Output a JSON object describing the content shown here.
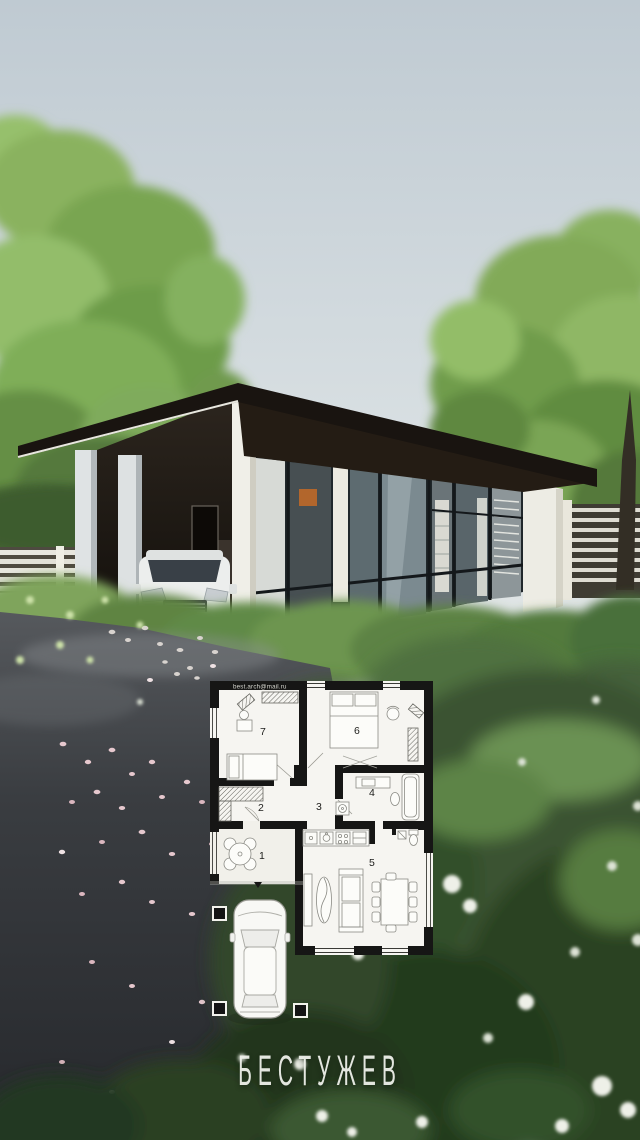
{
  "frame": {
    "title": "БЕСТУЖЕВ",
    "watermark": "best.arch@mail.ru"
  },
  "plan": {
    "rooms": [
      {
        "label": "1"
      },
      {
        "label": "2"
      },
      {
        "label": "3"
      },
      {
        "label": "4"
      },
      {
        "label": "5"
      },
      {
        "label": "6"
      },
      {
        "label": "7"
      }
    ]
  },
  "palette": {
    "sky": "#c9d2d8",
    "foliage_light": "#8ab25e",
    "foliage_dark": "#3f5d2a",
    "roof": "#191410",
    "house_white": "#f0efe8",
    "glass": "#7b8a90",
    "plan_wall": "#161615",
    "plan_floor": "#f6f5f1",
    "asphalt": "#35383c",
    "petal_pink": "#e3c2c9",
    "title_white": "#eef0ea"
  }
}
